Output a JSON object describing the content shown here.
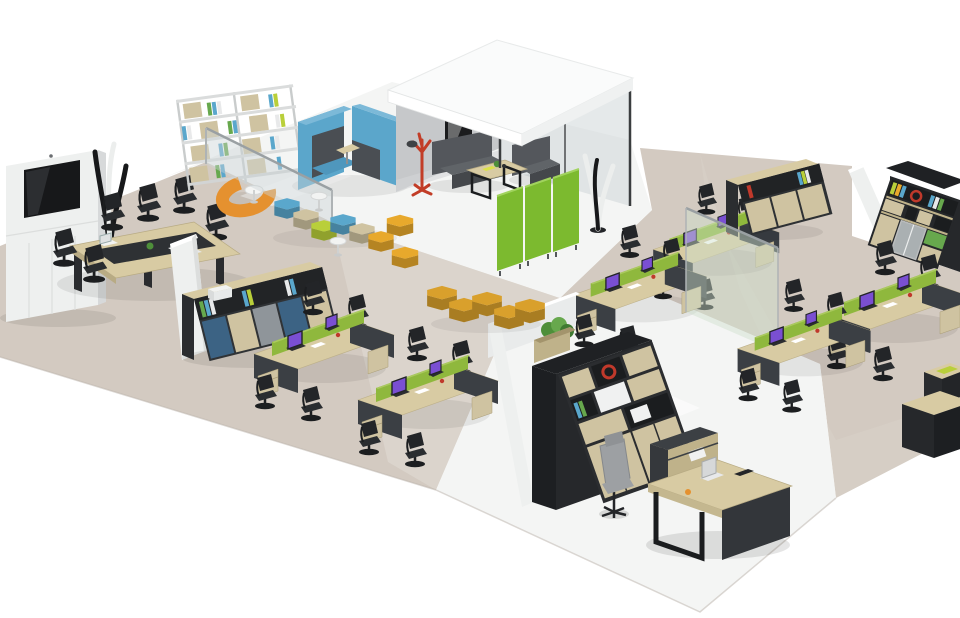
{
  "scene": {
    "kind": "isometric-3d-render",
    "subject": "open-plan office furniture layout",
    "background": "#ffffff"
  },
  "palette": {
    "carpet": "#d3cac1",
    "carpet_light": "#ded7cf",
    "floor_white": "#f4f5f4",
    "wall_white": "#eef0ef",
    "wall_side": "#d7d9da",
    "wall_gray": "#c6c8ca",
    "roof_white": "#fafbfb",
    "wood": "#d8cba3",
    "wood_dark": "#bfb28a",
    "panel_dark": "#3b3f44",
    "black": "#1d1f22",
    "screen_green": "#8fb83d",
    "screen_green_top": "#aac95e",
    "partition_green": "#7cba2f",
    "sofa_blue": "#5ba6cb",
    "sofa_blue_top": "#7cb9d8",
    "sofa_dark": "#54575c",
    "pouf_yellow": "#e8a92c",
    "pouf_orange": "#e5912f",
    "pouf_mustard": "#d9a02c",
    "hex_lime": "#b9cf3a",
    "hex_tan": "#cfc3a1",
    "hex_blue": "#5aa7cc",
    "coatrack_red": "#c23d27",
    "glass": "#ccd4d6",
    "glass_green": "#cfe0cb",
    "chair_black": "#232528",
    "chair_gray": "#9da0a3",
    "cabinet_blue": "#3c6384",
    "cabinet_gray": "#8f959a",
    "bookcase_dark": "#26282b",
    "plant_green": "#4e8f3a",
    "plant_green2": "#67a84d",
    "laptop_screen": "#7a4fd2",
    "tv_black": "#17181a",
    "white": "#ffffff",
    "sculpt_white": "#eceeed",
    "sculpt_black": "#17181a"
  },
  "zones": [
    {
      "name": "meeting-room",
      "floor": "carpet",
      "furniture": [
        "media-wall-with-display",
        "coat-stand-sculpture",
        "conference-table",
        "task-chairs-x6",
        "laptop",
        "desk-plant"
      ]
    },
    {
      "name": "lounge-library",
      "floor": "white-gloss",
      "furniture": [
        "open-shelving-unit",
        "curved-orange-bench",
        "round-white-table",
        "blue-acoustic-booth-sofas",
        "modular-hex-seating",
        "bistro-tables-x2",
        "yellow-poufs-x2",
        "glass-partition"
      ]
    },
    {
      "name": "meeting-pod",
      "floor": "white-gloss",
      "furniture": [
        "white-canopy-roof",
        "gray-wall",
        "glass-wall",
        "wall-picture",
        "red-coat-rack",
        "dark-sofa",
        "dark-armchair",
        "coffee-table",
        "tree-sculpture"
      ]
    },
    {
      "name": "open-office-west",
      "floor": "carpet",
      "furniture": [
        "white-partition-wall",
        "storage-credenza-with-printer",
        "workstation-cluster-4p",
        "workstation-cluster-4p"
      ]
    },
    {
      "name": "open-office-east",
      "floor": "carpet",
      "furniture": [
        "green-folding-partition",
        "workstation-cluster-4p",
        "workstation-cluster-4p",
        "workstation-cluster-4p",
        "workstation-cluster-4p",
        "storage-credenza",
        "white-wall",
        "tall-bookcase",
        "glass-partition"
      ]
    },
    {
      "name": "executive-office",
      "floor": "white-gloss",
      "furniture": [
        "white-walls",
        "planter-box",
        "tall-bookcase",
        "executive-desk",
        "laptop",
        "executive-chair",
        "side-cabinet"
      ]
    },
    {
      "name": "circulation",
      "floor": "carpet",
      "furniture": [
        "mustard-hex-pouf-chain",
        "low-cabinets"
      ]
    }
  ],
  "counts": {
    "workstation_clusters": 6,
    "seats_per_cluster": 4,
    "meeting_pods": 1
  }
}
